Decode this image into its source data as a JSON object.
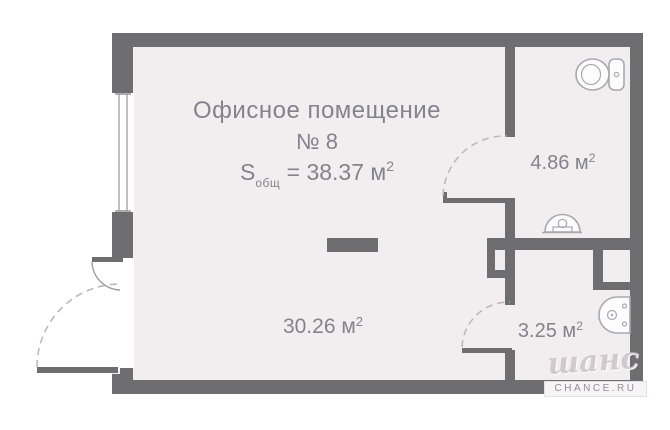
{
  "colors": {
    "wall": "#6e6e70",
    "floor": "#f2eef0",
    "text": "#83838d",
    "dash": "#beb7bb",
    "fixture_stroke": "#a9a9ad",
    "watermark": "#d0cacd"
  },
  "header": {
    "title": "Офисное помещение",
    "number": "№ 8",
    "formula": {
      "symbol": "S",
      "subscript": "общ",
      "rest": "= 38.37 м",
      "sup": "2"
    }
  },
  "rooms": [
    {
      "id": "office",
      "area_value": "30.26 м",
      "area_sup": "2"
    },
    {
      "id": "wc-top",
      "area_value": "4.86 м",
      "area_sup": "2"
    },
    {
      "id": "wc-bottom",
      "area_value": "3.25 м",
      "area_sup": "2"
    }
  ],
  "icons": {
    "toilet": "toilet-top-view-icon",
    "washbasin": "washbasin-top-view-icon",
    "round_basin": "round-basin-top-view-icon"
  },
  "watermark": {
    "script": "шанс",
    "site": "CHANCE.RU"
  }
}
